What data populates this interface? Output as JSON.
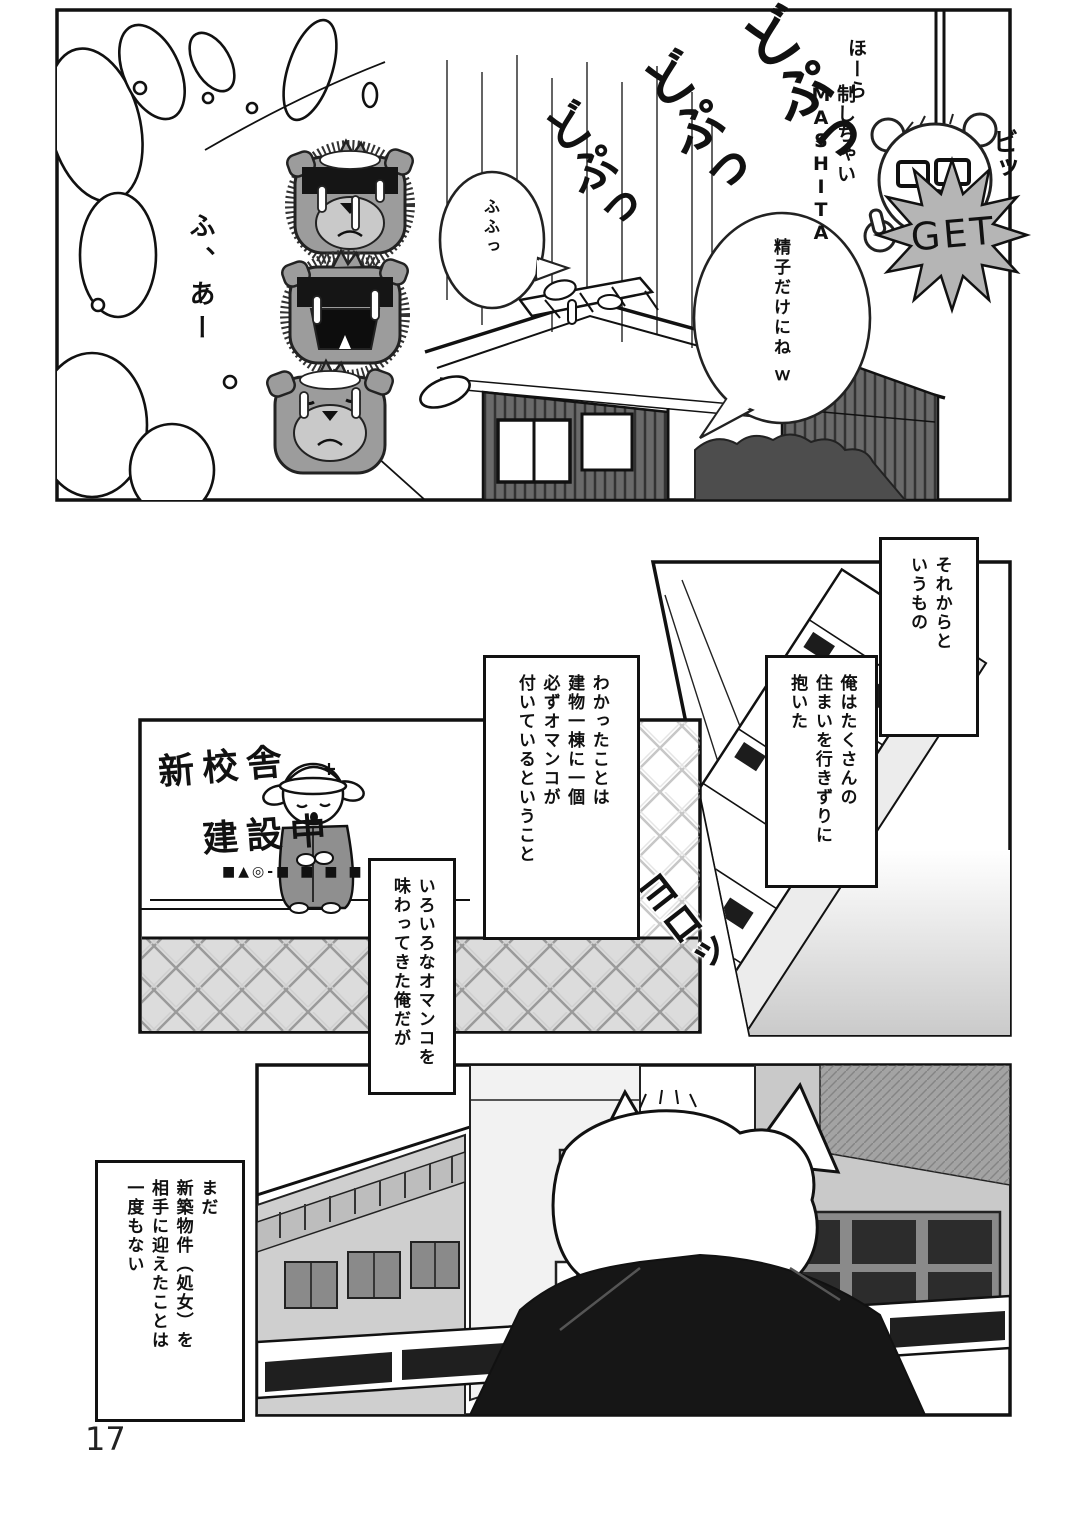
{
  "page": {
    "number": "17"
  },
  "panel1": {
    "sfx_splash": [
      "どぷっ",
      "どぷっ",
      "どぷっ"
    ],
    "sigh": "ふ、あー",
    "bubble_small": "ふふっ",
    "bubble_large": "精子だけにね ｗ",
    "caption_top": "ほーら",
    "caption_top2": "制しちゃいMASHITA",
    "sfx_click": "ビッ",
    "badge": "GET"
  },
  "panel2": {
    "caption_1": "それからと\nいうもの",
    "caption_2": "俺はたくさんの\n住まいを行きずりに\n抱いた",
    "sfx_stagger": "ヨロッ"
  },
  "panel3": {
    "sign_title": "新校舎",
    "sign_subtitle": "建設中",
    "sign_fineprint": "■▲◎-■ ■ ■ ■",
    "caption_1": "わかったことは\n建物一棟に一個\n必ずオマンコが\n付いているということ",
    "caption_2": "いろいろなオマンコを\n味わってきた俺だが"
  },
  "panel4": {
    "caption_1": "まだ\n新築物件（処女）を\n相手に迎えたことは\n一度もない"
  },
  "colors": {
    "tone_gray": "#c9c9c9",
    "dark_gray": "#8f8f8f",
    "badge_gray": "#b5b5b5",
    "ink": "#111111"
  }
}
